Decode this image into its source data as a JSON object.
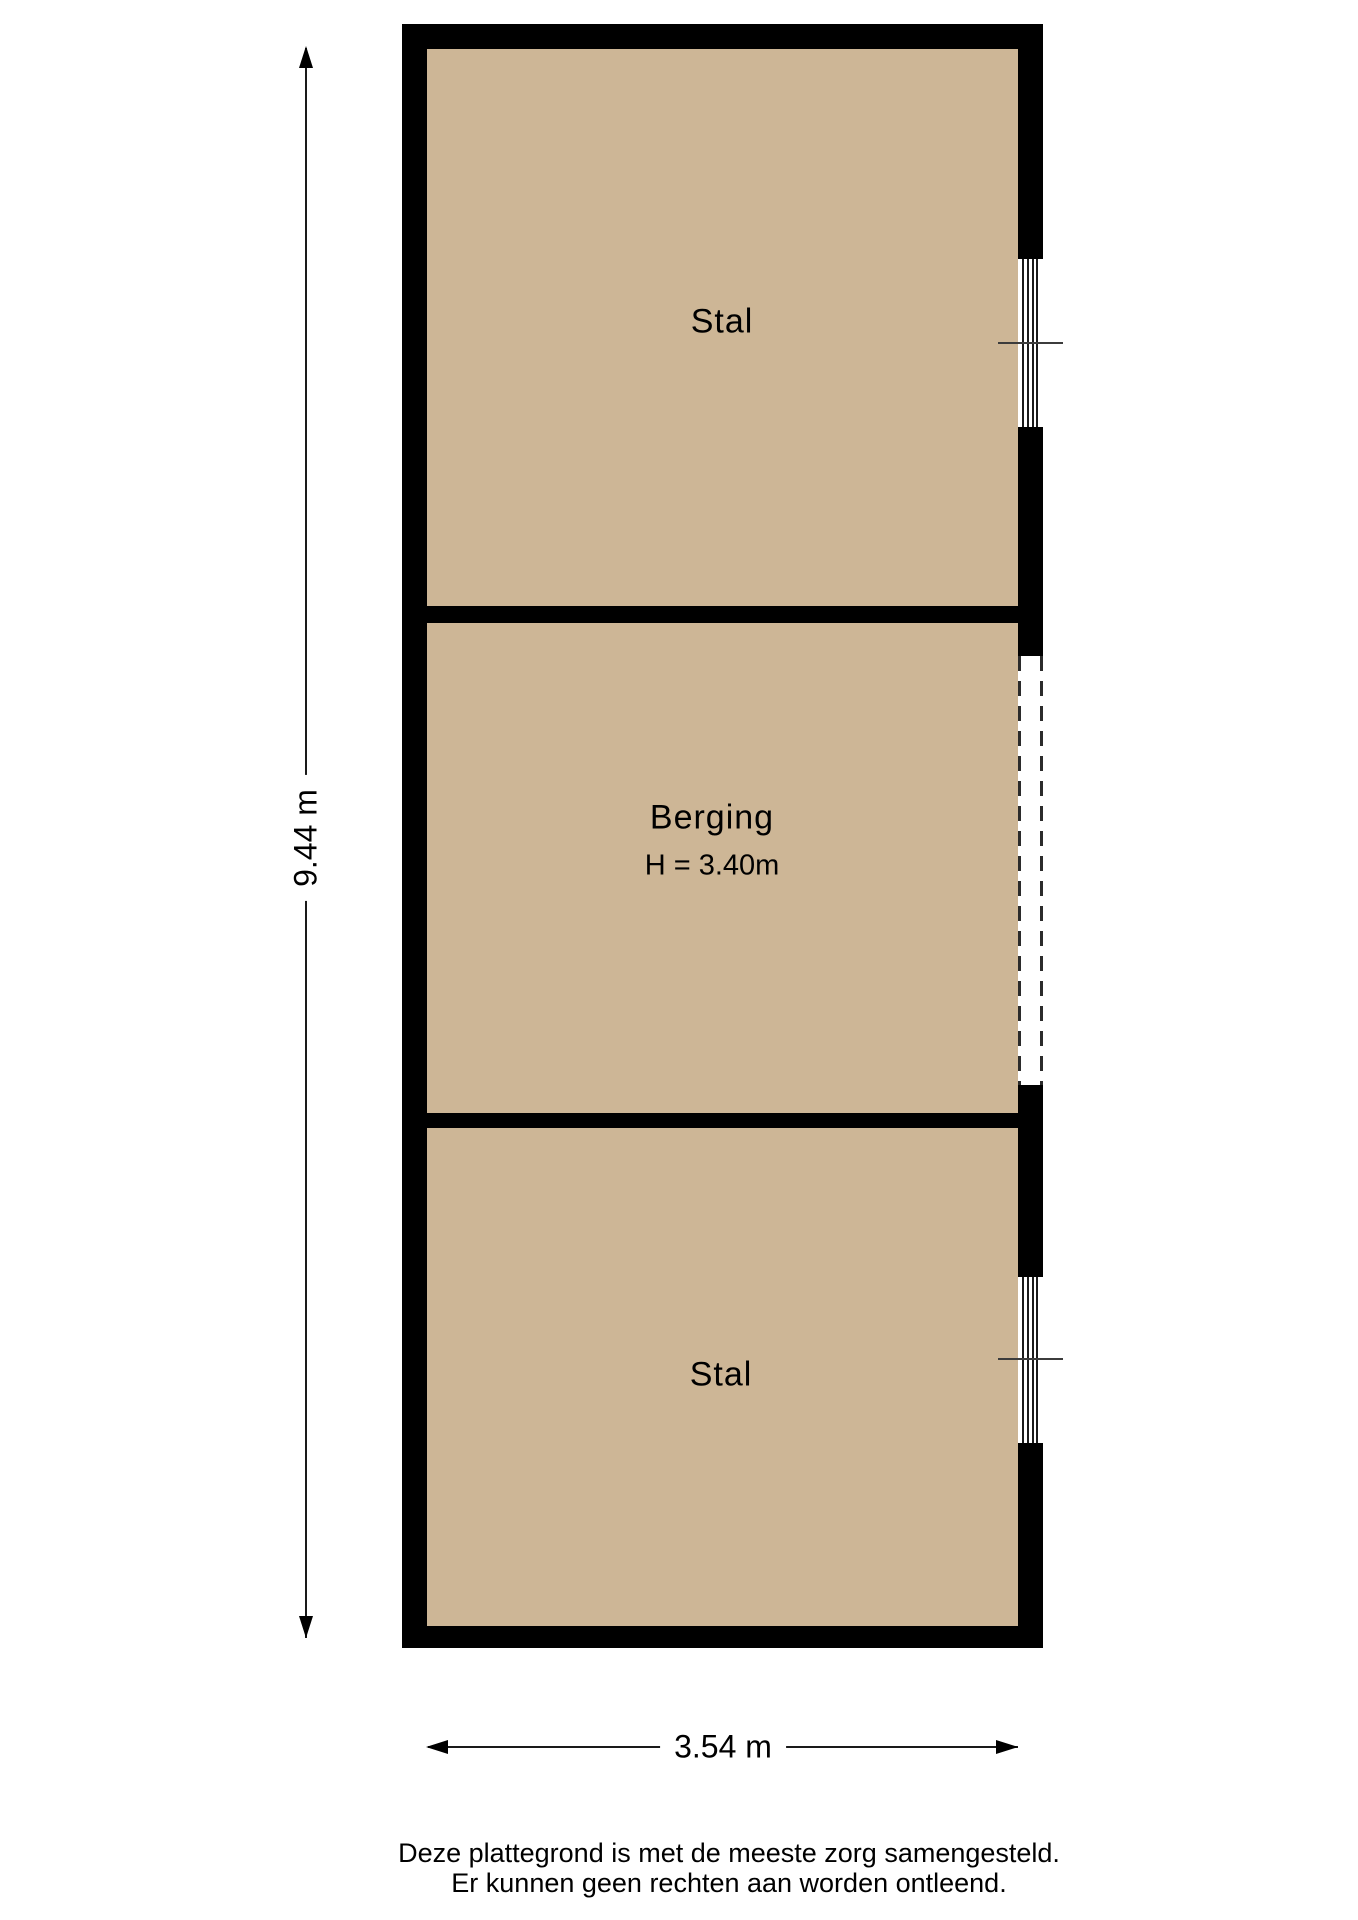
{
  "floorplan": {
    "type": "floor-plan",
    "rooms": [
      {
        "id": "stal-top",
        "label": "Stal"
      },
      {
        "id": "berging",
        "label": "Berging",
        "height_label": "H = 3.40m"
      },
      {
        "id": "stal-bottom",
        "label": "Stal"
      }
    ],
    "features": [
      {
        "id": "window-top",
        "type": "window",
        "wall": "right",
        "room": "stal-top"
      },
      {
        "id": "opening-berging",
        "type": "dashed-opening",
        "wall": "right",
        "room": "berging"
      },
      {
        "id": "window-bottom",
        "type": "window",
        "wall": "right",
        "room": "stal-bottom"
      }
    ],
    "colors": {
      "floor": "#cdb696",
      "wall": "#000000",
      "opening": "#ffffff",
      "dash": "#2b2b2b",
      "sill": "#3c3c3c"
    }
  },
  "dimensions": {
    "vertical_label": "9.44 m",
    "horizontal_label": "3.54 m"
  },
  "footer": {
    "line1": "Deze plattegrond is met de meeste zorg samengesteld.",
    "line2": "Er kunnen geen rechten aan worden ontleend."
  }
}
